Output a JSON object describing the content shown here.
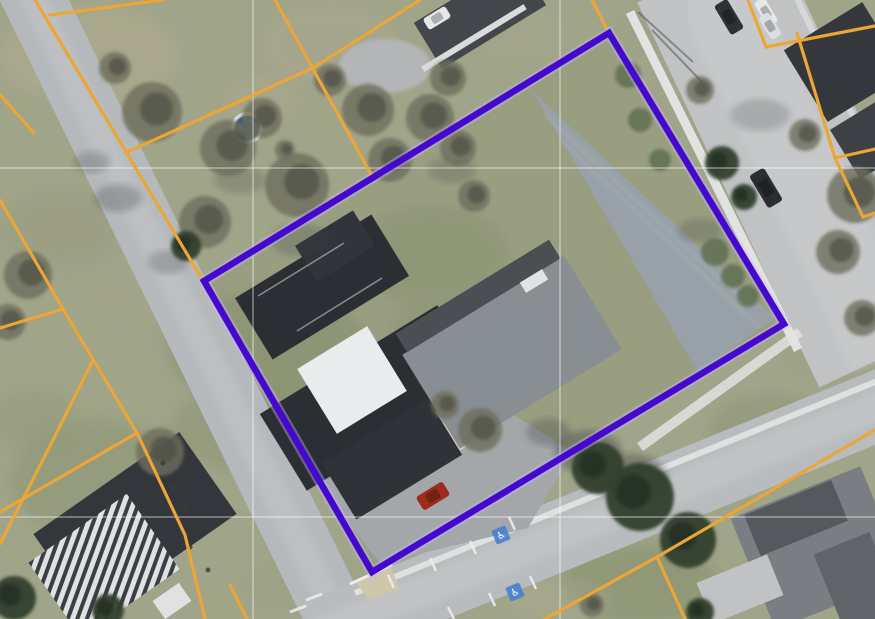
{
  "scene": {
    "width": 875,
    "height": 619,
    "kind": "aerial-parcel-map"
  },
  "palette": {
    "grass_base": "#a0a489",
    "parcel_tint": "#8a9370",
    "road_fill": "#b6b9bc",
    "road_b_fill": "#c0c2c4",
    "road_c_fill": "#b9bcbe",
    "sidewalk": "#e6e7e6",
    "parking_upper": "#98a1a8",
    "parking_lower": "#a4a7a9",
    "boundary_purple": "#4408cf",
    "boundary_halo": "#c7b9ef",
    "parcel_line_orange": "#eba636",
    "gridline": "rgba(255,255,255,0.33)",
    "handicap_blue": "#4a80cc",
    "conifer": "#33402f",
    "bare_tree": "#6e6e5d",
    "bush": "#5f7050",
    "shadow": "#3f4547"
  },
  "parcel": {
    "corners": [
      [
        609,
        33
      ],
      [
        784,
        324
      ],
      [
        372,
        572
      ],
      [
        204,
        281
      ]
    ],
    "stroke_width": 6.5,
    "halo_width": 11
  },
  "orange_lines": {
    "width": 3.2,
    "segments": [
      [
        [
          0,
          95
        ],
        [
          34,
          133
        ]
      ],
      [
        [
          0,
          200
        ],
        [
          63,
          309
        ],
        [
          137,
          433
        ],
        [
          185,
          535
        ],
        [
          205,
          619
        ]
      ],
      [
        [
          0,
          328
        ],
        [
          63,
          309
        ]
      ],
      [
        [
          0,
          512
        ],
        [
          137,
          433
        ]
      ],
      [
        [
          0,
          544
        ],
        [
          53,
          440
        ],
        [
          92,
          362
        ]
      ],
      [
        [
          230,
          585
        ],
        [
          247,
          619
        ]
      ],
      [
        [
          35,
          0
        ],
        [
          83,
          80
        ],
        [
          202,
          279
        ]
      ],
      [
        [
          50,
          15
        ],
        [
          163,
          0
        ]
      ],
      [
        [
          275,
          0
        ],
        [
          373,
          178
        ]
      ],
      [
        [
          125,
          153
        ],
        [
          313,
          68
        ],
        [
          420,
          0
        ]
      ],
      [
        [
          592,
          0
        ],
        [
          609,
          33
        ]
      ],
      [
        [
          748,
          0
        ],
        [
          766,
          47
        ],
        [
          875,
          26
        ]
      ],
      [
        [
          797,
          33
        ],
        [
          835,
          158
        ],
        [
          863,
          217
        ],
        [
          875,
          213
        ]
      ],
      [
        [
          835,
          158
        ],
        [
          875,
          149
        ]
      ],
      [
        [
          875,
          430
        ],
        [
          657,
          557
        ],
        [
          545,
          619
        ]
      ],
      [
        [
          657,
          557
        ],
        [
          685,
          619
        ]
      ]
    ]
  },
  "gridlines": {
    "x": [
      253,
      560
    ],
    "y": [
      168,
      517
    ]
  },
  "roads": [
    {
      "name": "road-west",
      "pts": [
        [
          22,
          -25
        ],
        [
          350,
          645
        ]
      ],
      "w": 62,
      "fill": "#b6b9bc",
      "ow": 26,
      "ofill": "#c3c5c7"
    },
    {
      "name": "road-east",
      "pts": [
        [
          706,
          -30
        ],
        [
          888,
          355
        ]
      ],
      "w": 152,
      "fill": "#c0c2c4",
      "ow": 80,
      "ofill": "#cbcdce"
    },
    {
      "name": "road-south",
      "pts": [
        [
          315,
          635
        ],
        [
          905,
          395
        ]
      ],
      "w": 70,
      "fill": "#b9bcbe",
      "ow": 30,
      "ofill": "#c6c8c9"
    }
  ],
  "sidewalks": [
    {
      "name": "sidewalk-east-road-west-side",
      "pts": [
        [
          630,
          12
        ],
        [
          798,
          350
        ]
      ],
      "w": 9,
      "fill": "#e6e7e6",
      "op": 0.95
    },
    {
      "name": "curb-south-road-north-side",
      "pts": [
        [
          355,
          593
        ],
        [
          885,
          378
        ]
      ],
      "w": 6,
      "fill": "#e3e4e3",
      "op": 0.9
    },
    {
      "name": "sidewalk-east-road-east-side",
      "pts": [
        [
          793,
          -10
        ],
        [
          868,
          148
        ]
      ],
      "w": 6,
      "fill": "#dfe0e0",
      "op": 0.7
    },
    {
      "name": "sidewalk-corner-east",
      "pts": [
        [
          640,
          447
        ],
        [
          800,
          332
        ]
      ],
      "w": 10,
      "fill": "#e2e3e2",
      "op": 0.85
    }
  ],
  "parking": {
    "upper": {
      "points": [
        [
          533,
          92
        ],
        [
          775,
          318
        ],
        [
          698,
          372
        ]
      ],
      "fill": "#98a1a8",
      "streaks": [
        [
          [
            560,
            140
          ],
          [
            760,
            328
          ]
        ],
        [
          [
            545,
            115
          ],
          [
            745,
            302
          ]
        ]
      ]
    },
    "lower": {
      "points": [
        [
          305,
          435
        ],
        [
          475,
          390
        ],
        [
          572,
          452
        ],
        [
          528,
          528
        ],
        [
          380,
          563
        ],
        [
          328,
          498
        ]
      ],
      "fill": "#a4a7a9"
    }
  },
  "patches": [
    [
      90,
      55,
      90,
      50,
      "#b2ac92",
      0.5
    ],
    [
      330,
      45,
      70,
      40,
      "#ada893",
      0.45
    ],
    [
      520,
      35,
      55,
      28,
      "#a6a78b",
      0.4
    ],
    [
      270,
      350,
      100,
      60,
      "#7e8c66",
      0.5
    ],
    [
      430,
      255,
      80,
      50,
      "#83906b",
      0.45
    ],
    [
      240,
      430,
      70,
      40,
      "#859069",
      0.4
    ],
    [
      100,
      480,
      90,
      60,
      "#8b9472",
      0.5
    ],
    [
      60,
      230,
      60,
      40,
      "#97997e",
      0.4
    ],
    [
      770,
      430,
      60,
      35,
      "#8b9273",
      0.45
    ],
    [
      640,
      585,
      80,
      40,
      "#79885f",
      0.4
    ],
    [
      200,
      330,
      50,
      30,
      "#9a9c80",
      0.35
    ],
    [
      825,
      355,
      40,
      25,
      "#9aa083",
      0.35
    ],
    [
      300,
      585,
      60,
      25,
      "#9aa184",
      0.35
    ],
    [
      120,
      300,
      50,
      35,
      "#a3a68a",
      0.4
    ],
    [
      430,
      330,
      40,
      25,
      "#7d8a64",
      0.35
    ],
    [
      262,
      100,
      40,
      24,
      "#b0a98e",
      0.4
    ],
    [
      560,
      600,
      50,
      20,
      "#b5b09a",
      0.3
    ],
    [
      35,
      420,
      45,
      30,
      "#909877",
      0.4
    ],
    [
      660,
      30,
      50,
      25,
      "#9aa285",
      0.35
    ]
  ],
  "driveway": {
    "x": 385,
    "y": 66,
    "rx": 46,
    "ry": 27,
    "fill": "#b3b5b6"
  },
  "corner_wedge": {
    "points": [
      [
        355,
        580
      ],
      [
        390,
        566
      ],
      [
        400,
        589
      ],
      [
        368,
        600
      ]
    ],
    "fill": "#cfc6ab",
    "curb": [
      [
        350,
        584
      ],
      [
        392,
        565
      ]
    ]
  },
  "buildings": [
    {
      "n": "top-house-roof",
      "c": [
        480,
        14
      ],
      "s": [
        122,
        54
      ],
      "r": -31.5,
      "f": "#43474c"
    },
    {
      "n": "top-house-eave",
      "c": [
        474,
        38
      ],
      "s": [
        120,
        6
      ],
      "r": -31.5,
      "f": "#d9dbdc"
    },
    {
      "n": "ne-house-roof",
      "c": [
        845,
        62
      ],
      "s": [
        84,
        92
      ],
      "r": 58.5,
      "f": "#34373c"
    },
    {
      "n": "ne-house2-roof",
      "c": [
        869,
        140
      ],
      "s": [
        58,
        56
      ],
      "r": 58.5,
      "f": "#3d4146"
    },
    {
      "n": "se-house-roof",
      "c": [
        818,
        548
      ],
      "s": [
        140,
        120
      ],
      "r": -22,
      "f": "#7a7e82"
    },
    {
      "n": "se-house-dark-wing",
      "c": [
        796,
        518
      ],
      "s": [
        94,
        44
      ],
      "r": -22,
      "f": "#55595e"
    },
    {
      "n": "se-house-dark-wing2",
      "c": [
        858,
        584
      ],
      "s": [
        60,
        88
      ],
      "r": -22,
      "f": "#606468"
    },
    {
      "n": "se-shed-roof",
      "c": [
        740,
        589
      ],
      "s": [
        76,
        44
      ],
      "r": -22,
      "f": "#c1c2c3"
    },
    {
      "n": "sw-building-dark-roof",
      "c": [
        135,
        524
      ],
      "s": [
        178,
        100
      ],
      "r": -35,
      "f": "#33373c"
    },
    {
      "n": "sw-building-striped-roof",
      "c": [
        104,
        566
      ],
      "s": [
        120,
        92
      ],
      "r": -35,
      "f": "stripes"
    },
    {
      "n": "sw-white-structure",
      "c": [
        172,
        601
      ],
      "s": [
        32,
        22
      ],
      "r": -35,
      "f": "#e0e1e2"
    },
    {
      "n": "main-building-north-wing",
      "c": [
        322,
        287
      ],
      "s": [
        160,
        72
      ],
      "r": -31.5,
      "f": "#2b2e33"
    },
    {
      "n": "main-building-north-block",
      "c": [
        335,
        246
      ],
      "s": [
        68,
        42
      ],
      "r": -31.5,
      "f": "#31343a"
    },
    {
      "n": "main-building-center-wing",
      "c": [
        372,
        398
      ],
      "s": [
        90,
        208
      ],
      "r": 58.5,
      "f": "#2b2e33"
    },
    {
      "n": "main-building-south-wing",
      "c": [
        392,
        459
      ],
      "s": [
        124,
        66
      ],
      "r": -31.5,
      "f": "#2f3237"
    },
    {
      "n": "main-building-white-roof",
      "c": [
        352,
        380
      ],
      "s": [
        82,
        76
      ],
      "r": -31.5,
      "f": "#e9ebec"
    },
    {
      "n": "main-building-east-wing",
      "c": [
        512,
        352
      ],
      "s": [
        190,
        110
      ],
      "r": -31.5,
      "f": "#898e93"
    },
    {
      "n": "east-wing-dark-edge",
      "c": [
        478,
        296
      ],
      "s": [
        180,
        22
      ],
      "r": -31.5,
      "f": "#4b4f54"
    },
    {
      "n": "east-wing-skylight",
      "c": [
        534,
        281
      ],
      "s": [
        26,
        12
      ],
      "r": -31.5,
      "f": "#e0e3e5"
    }
  ],
  "ridge_lines": [
    [
      [
        258,
        296
      ],
      [
        344,
        243
      ]
    ],
    [
      [
        297,
        331
      ],
      [
        382,
        278
      ]
    ]
  ],
  "pads": [
    {
      "n": "concrete-pad",
      "c": [
        440,
        444
      ],
      "s": [
        42,
        32
      ],
      "r": -31.5,
      "f": "#d8cfb5"
    }
  ],
  "pool": {
    "x": 247,
    "y": 128,
    "r": 12,
    "ring": "#d5d9da",
    "water": "#3b5a78",
    "deep": "#2c4158"
  },
  "trees": {
    "bare": [
      [
        152,
        112,
        30
      ],
      [
        228,
        148,
        28
      ],
      [
        262,
        118,
        20
      ],
      [
        297,
        185,
        32
      ],
      [
        205,
        222,
        26
      ],
      [
        368,
        110,
        26
      ],
      [
        330,
        80,
        16
      ],
      [
        430,
        118,
        24
      ],
      [
        390,
        160,
        22
      ],
      [
        448,
        78,
        18
      ],
      [
        458,
        148,
        18
      ],
      [
        474,
        196,
        16
      ],
      [
        115,
        68,
        16
      ],
      [
        28,
        275,
        24
      ],
      [
        8,
        322,
        18
      ],
      [
        160,
        452,
        24
      ],
      [
        855,
        195,
        28
      ],
      [
        838,
        252,
        22
      ],
      [
        862,
        318,
        18
      ],
      [
        480,
        430,
        22
      ],
      [
        445,
        405,
        14
      ],
      [
        700,
        90,
        14
      ],
      [
        805,
        135,
        16
      ],
      [
        285,
        150,
        10
      ],
      [
        592,
        605,
        12
      ]
    ],
    "conifer": [
      [
        186,
        246,
        15
      ],
      [
        640,
        497,
        34
      ],
      [
        598,
        468,
        26
      ],
      [
        688,
        540,
        28
      ],
      [
        14,
        598,
        22
      ],
      [
        108,
        610,
        16
      ],
      [
        700,
        612,
        14
      ],
      [
        722,
        163,
        17
      ],
      [
        744,
        197,
        13
      ]
    ],
    "bush": [
      [
        715,
        252,
        14
      ],
      [
        733,
        276,
        12
      ],
      [
        748,
        296,
        11
      ],
      [
        628,
        75,
        13
      ],
      [
        640,
        120,
        12
      ],
      [
        660,
        160,
        11
      ]
    ]
  },
  "shadows": [
    [
      588,
      452,
      34,
      22,
      0.4
    ],
    [
      630,
      478,
      38,
      24,
      0.4
    ],
    [
      548,
      432,
      22,
      14,
      0.3
    ],
    [
      118,
      198,
      24,
      14,
      0.28
    ],
    [
      92,
      162,
      18,
      11,
      0.25
    ],
    [
      168,
      262,
      20,
      12,
      0.25
    ],
    [
      452,
      170,
      24,
      13,
      0.22
    ],
    [
      760,
      115,
      30,
      16,
      0.22
    ],
    [
      700,
      230,
      22,
      12,
      0.25
    ],
    [
      300,
      240,
      30,
      16,
      0.25
    ],
    [
      240,
      180,
      26,
      14,
      0.22
    ]
  ],
  "cars": [
    {
      "n": "red-car",
      "c": [
        433,
        496
      ],
      "s": [
        31,
        16
      ],
      "r": -31.5,
      "f": "#9b2c1e"
    },
    {
      "n": "dark-car-east-road",
      "c": [
        766,
        188
      ],
      "s": [
        38,
        17
      ],
      "r": 59,
      "f": "#2a2d33"
    },
    {
      "n": "dark-car-north",
      "c": [
        729,
        17
      ],
      "s": [
        34,
        15
      ],
      "r": 59,
      "f": "#2e3136"
    },
    {
      "n": "white-car-1",
      "c": [
        766,
        12
      ],
      "s": [
        28,
        12
      ],
      "r": 59,
      "f": "#e8e9ea"
    },
    {
      "n": "white-car-2",
      "c": [
        770,
        26
      ],
      "s": [
        26,
        12
      ],
      "r": 59,
      "f": "#dcdedf"
    },
    {
      "n": "white-car-driveway",
      "c": [
        437,
        18
      ],
      "s": [
        26,
        13
      ],
      "r": -31.5,
      "f": "#e6e7e8"
    }
  ],
  "markings": {
    "stall_ticks": [
      [
        [
          470,
          541
        ],
        [
          476,
          554
        ]
      ],
      [
        [
          509,
          517
        ],
        [
          515,
          530
        ]
      ],
      [
        [
          430,
          558
        ],
        [
          436,
          571
        ]
      ],
      [
        [
          388,
          575
        ],
        [
          394,
          588
        ]
      ],
      [
        [
          489,
          593
        ],
        [
          495,
          606
        ]
      ],
      [
        [
          530,
          576
        ],
        [
          536,
          589
        ]
      ],
      [
        [
          448,
          607
        ],
        [
          454,
          619
        ]
      ]
    ],
    "dashes": [
      [
        [
          306,
          600
        ],
        [
          322,
          594
        ]
      ],
      [
        [
          290,
          612
        ],
        [
          306,
          606
        ]
      ]
    ],
    "handicap": {
      "size": 15,
      "glyph": "♿",
      "spots": [
        {
          "x": 501,
          "y": 535,
          "r": -22
        },
        {
          "x": 515,
          "y": 592,
          "r": -22
        }
      ]
    },
    "pole_shadows": [
      [
        [
          693,
          62
        ],
        [
          638,
          12
        ]
      ],
      [
        [
          702,
          82
        ],
        [
          652,
          30
        ]
      ]
    ],
    "posts": [
      [
        163,
        463
      ],
      [
        173,
        487
      ],
      [
        185,
        505
      ],
      [
        200,
        528
      ],
      [
        190,
        547
      ],
      [
        208,
        570
      ]
    ]
  }
}
